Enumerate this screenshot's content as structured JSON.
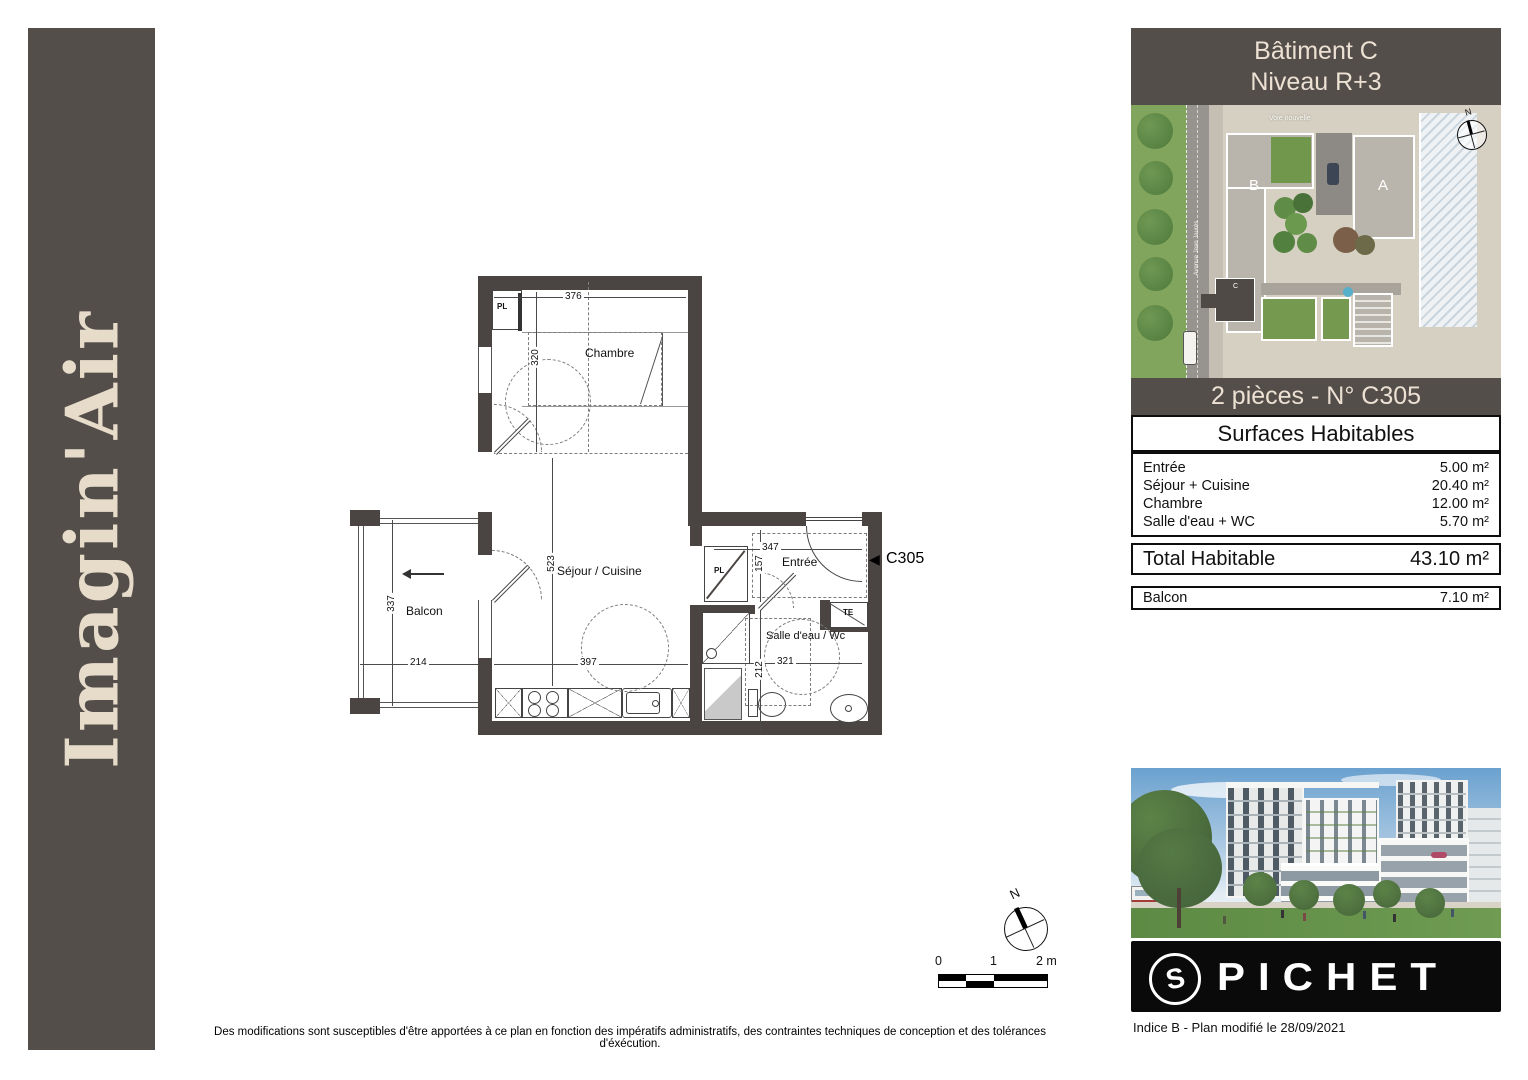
{
  "theme": {
    "brand_dark": "#544e4b",
    "cream": "#ece1d3",
    "wall": "#4a4542",
    "logo_black": "#0a0a0b"
  },
  "sidebar": {
    "brand": "Imagin'Air"
  },
  "panel": {
    "header_line1": "Bâtiment C",
    "header_line2": "Niveau R+3",
    "unit_title": "2 pièces - N° C305",
    "surfaces_title": "Surfaces Habitables",
    "rows": [
      {
        "label": "Entrée",
        "value": "5.00 m²"
      },
      {
        "label": "Séjour + Cuisine",
        "value": "20.40 m²"
      },
      {
        "label": "Chambre",
        "value": "12.00 m²"
      },
      {
        "label": "Salle d'eau + WC",
        "value": "5.70 m²"
      }
    ],
    "total_label": "Total Habitable",
    "total_value": "43.10 m²",
    "balcony_label": "Balcon",
    "balcony_value": "7.10 m²",
    "logo_text": "PICHET",
    "logo_emblem": "S",
    "revision": "Indice B - Plan modifié le 28/09/2021"
  },
  "site_map": {
    "building_a": "A",
    "building_b": "B",
    "building_c": "C",
    "street_top": "Voie nouvelle",
    "street_left": "Avenue Jean Jaurès",
    "north": "N"
  },
  "plan": {
    "labels": {
      "chambre": "Chambre",
      "sejour": "Séjour / Cuisine",
      "balcon": "Balcon",
      "entree": "Entrée",
      "salle_eau": "Salle d'eau / Wc",
      "pl": "PL",
      "te": "TE"
    },
    "unit_marker": "C305",
    "dims": {
      "d376": "376",
      "d320": "320",
      "d523": "523",
      "d397": "397",
      "d337": "337",
      "d214": "214",
      "d347": "347",
      "d157": "157",
      "d321": "321",
      "d212": "212"
    }
  },
  "scale_bar": {
    "t0": "0",
    "t1": "1",
    "t2": "2 m"
  },
  "compass": {
    "north": "N"
  },
  "footer": {
    "disclaimer": "Des modifications sont susceptibles d'être apportées à ce plan en fonction des impératifs administratifs, des contraintes techniques de conception et des tolérances d'éxécution."
  }
}
